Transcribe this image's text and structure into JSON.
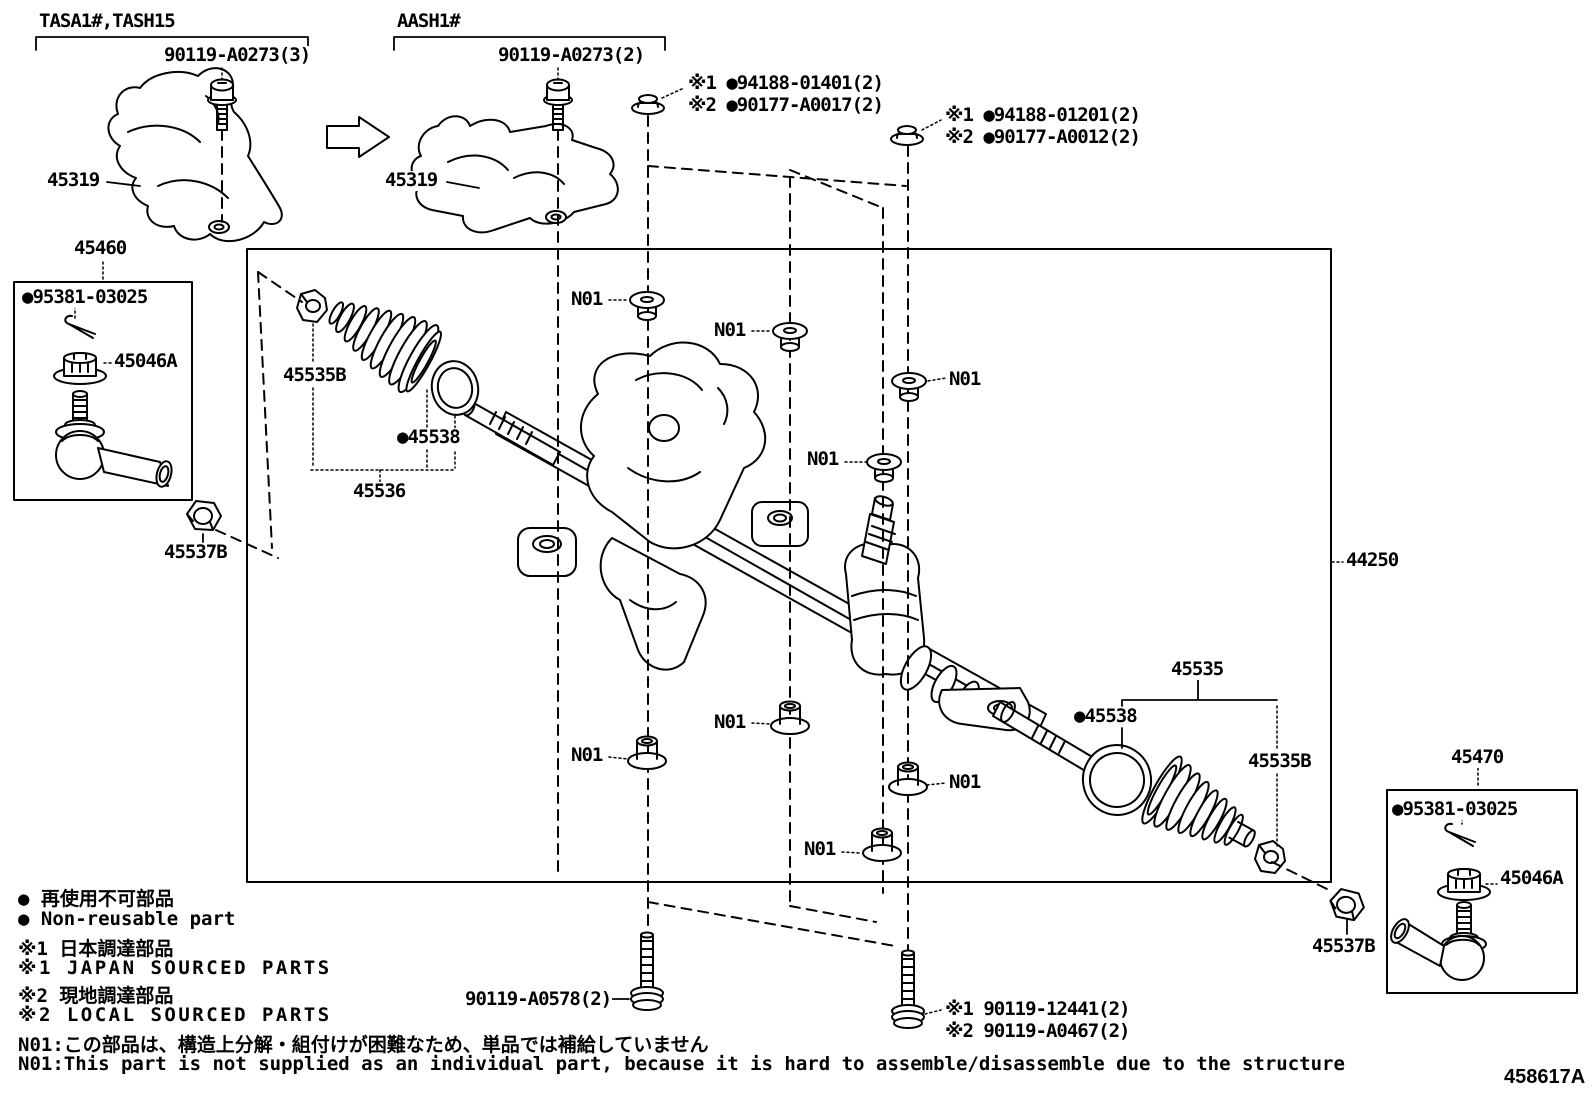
{
  "colors": {
    "line": "#000000",
    "background": "#ffffff"
  },
  "groups": {
    "variant_left": "TASA1#,TASH15",
    "variant_right": "AASH1#"
  },
  "labels": {
    "heat_shield": "45319",
    "shield_bolt_left": "90119-A0273(3)",
    "shield_bolt_right": "90119-A0273(2)",
    "nut_a_line1": "※1 ●94188-01401(2)",
    "nut_a_line2": "※2 ●90177-A0017(2)",
    "nut_b_line1": "※1 ●94188-01201(2)",
    "nut_b_line2": "※2 ●90177-A0012(2)",
    "tie_rod_end_left_box": "45460",
    "tie_rod_end_right_box": "45470",
    "cotter_pin": "●95381-03025",
    "castle_nut": "45046A",
    "boot_clamp": "45535B",
    "boot_clip": "●45538",
    "boot_left": "45536",
    "boot_right": "45535",
    "lock_nut": "45537B",
    "gear_assembly": "44250",
    "grommet": "N01",
    "mount_bolt_left": "90119-A0578(2)",
    "mount_bolt_right_line1": "※1 90119-12441(2)",
    "mount_bolt_right_line2": "※2 90119-A0467(2)"
  },
  "legend": [
    "● 再使用不可部品",
    "● Non-reusable part",
    "※1 日本調達部品",
    "※1 JAPAN SOURCED PARTS",
    "※2 現地調達部品",
    "※2 LOCAL SOURCED PARTS",
    "N01:この部品は、構造上分解・組付けが困難なため、単品では補給していません",
    "N01:This part is not supplied as an individual part, because it is hard to assemble/disassemble due to the structure"
  ],
  "title_code": "458617A"
}
